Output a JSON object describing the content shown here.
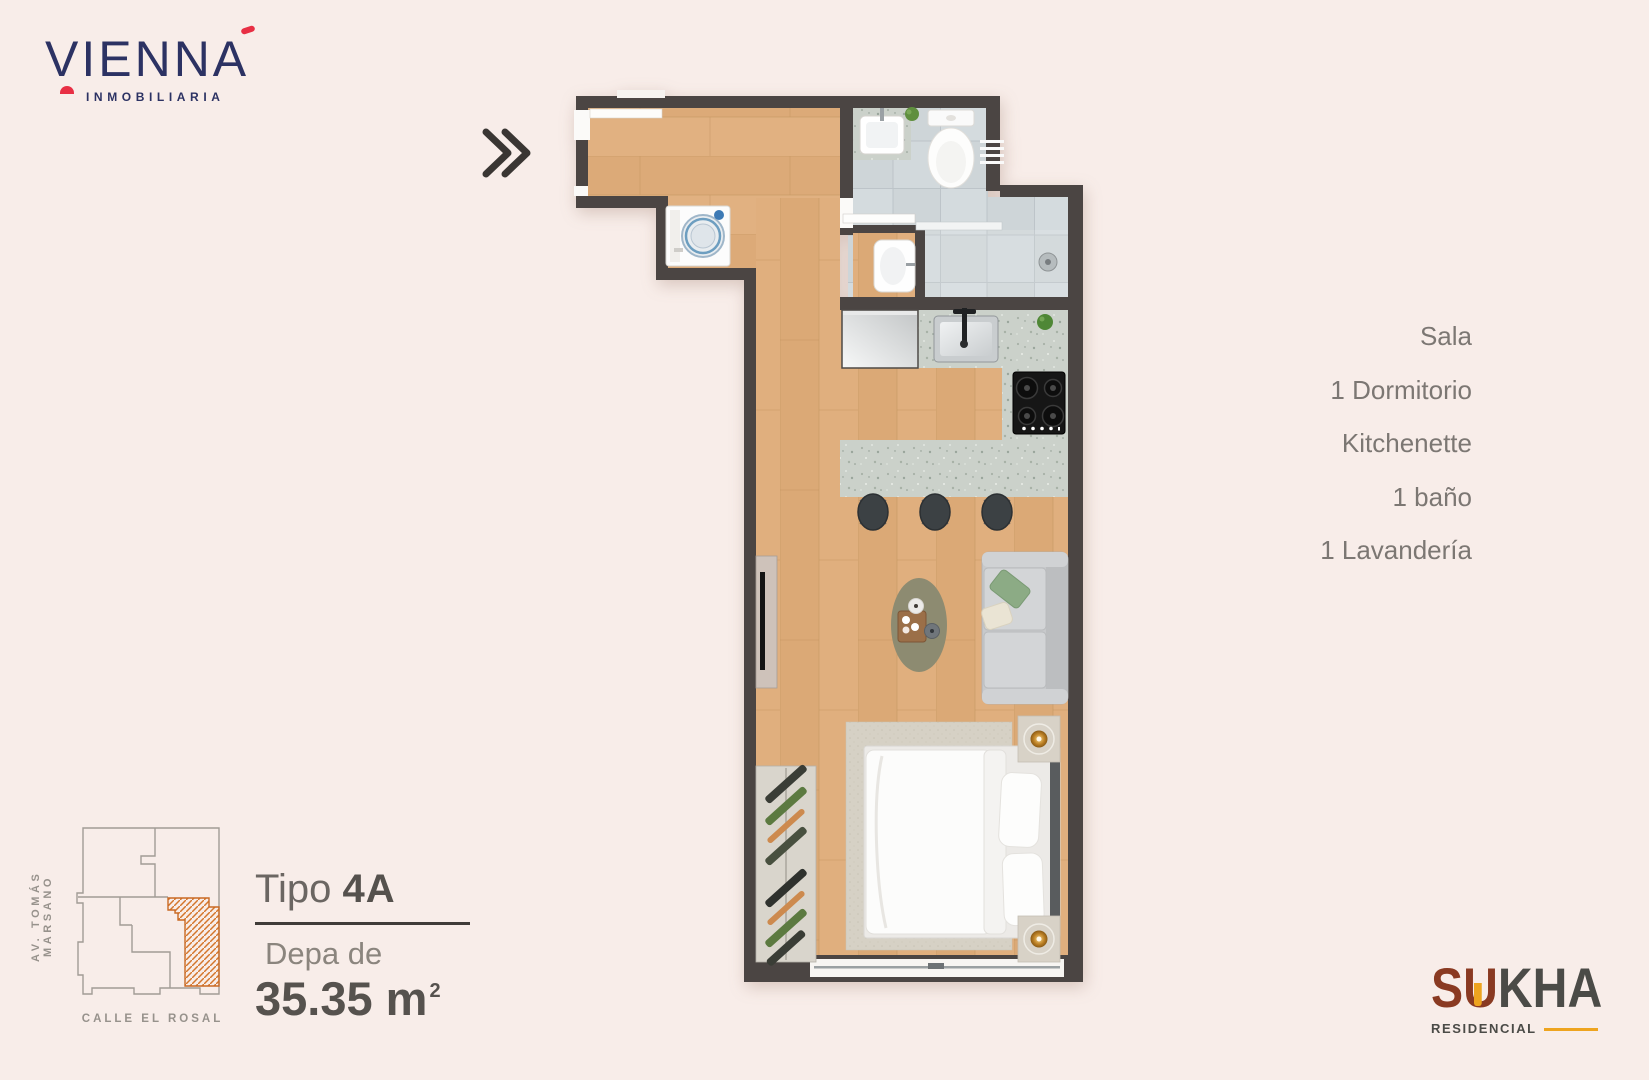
{
  "brand": {
    "name": "VIENNA",
    "tagline": "INMOBILIARIA",
    "accent_color": "#e82f44",
    "navy_color": "#2c3263"
  },
  "features": {
    "items": [
      "Sala",
      "1 Dormitorio",
      "Kitchenette",
      "1 baño",
      "1 Lavandería"
    ]
  },
  "unit": {
    "type_label": "Tipo",
    "type_code": "4A",
    "area_label": "Depa de",
    "area_value": "35.35 m",
    "area_exponent": "2"
  },
  "location_map": {
    "street_left": "AV. TOMÁS MARSANO",
    "street_bottom": "CALLE EL ROSAL",
    "highlight_color": "#d4762c"
  },
  "developer": {
    "name_part1": "SU",
    "name_part2": "KHA",
    "subtitle": "RESIDENCIAL",
    "rust_color": "#8a3a22",
    "gold_color": "#eea41f"
  },
  "plan": {
    "wall_color": "#4b4543",
    "wood_color": "#e0af7e",
    "tile_color": "#ced5d8",
    "counter_color": "#cbd1ca"
  }
}
